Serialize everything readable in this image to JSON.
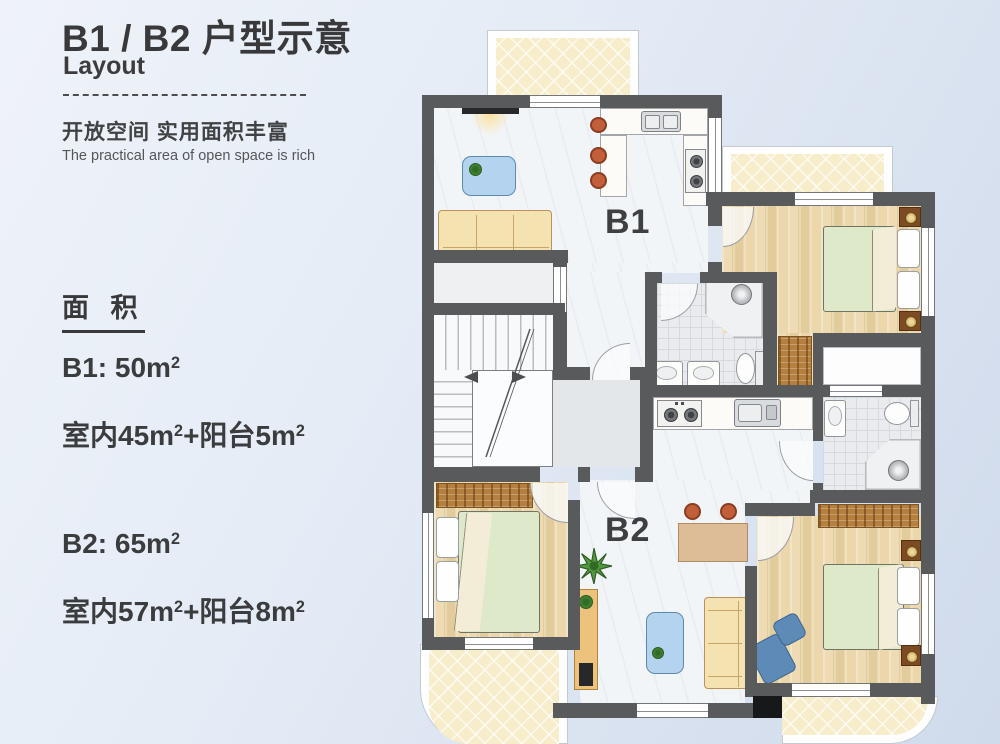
{
  "panel": {
    "title": "B1 / B2 户型示意",
    "subtitle": "Layout",
    "tagline_zh": "开放空间  实用面积丰富",
    "tagline_en": "The practical area of open space is rich",
    "area": {
      "heading": "面 积",
      "items": [
        {
          "line1": [
            "B1:  50m",
            "2"
          ],
          "line2": [
            "室内45m",
            "2",
            "+阳台5m",
            "2"
          ]
        },
        {
          "line1": [
            "B2:  65m",
            "2"
          ],
          "line2": [
            "室内57m",
            "2",
            "+阳台8m",
            "2"
          ]
        }
      ]
    }
  },
  "plan": {
    "unit_b1_label": "B1",
    "unit_b2_label": "B2",
    "colors": {
      "wall": "#595a5c",
      "balcony_floor": "#f7edcb",
      "wood_floor": "#e9d5ab",
      "marble_floor": "#f2f5f8",
      "bed_cover": "#dde9c9",
      "sofa": "#f4e2b0",
      "coffee_table_blue": "#b4d3ee",
      "stool_orange": "#c05f3a"
    }
  }
}
